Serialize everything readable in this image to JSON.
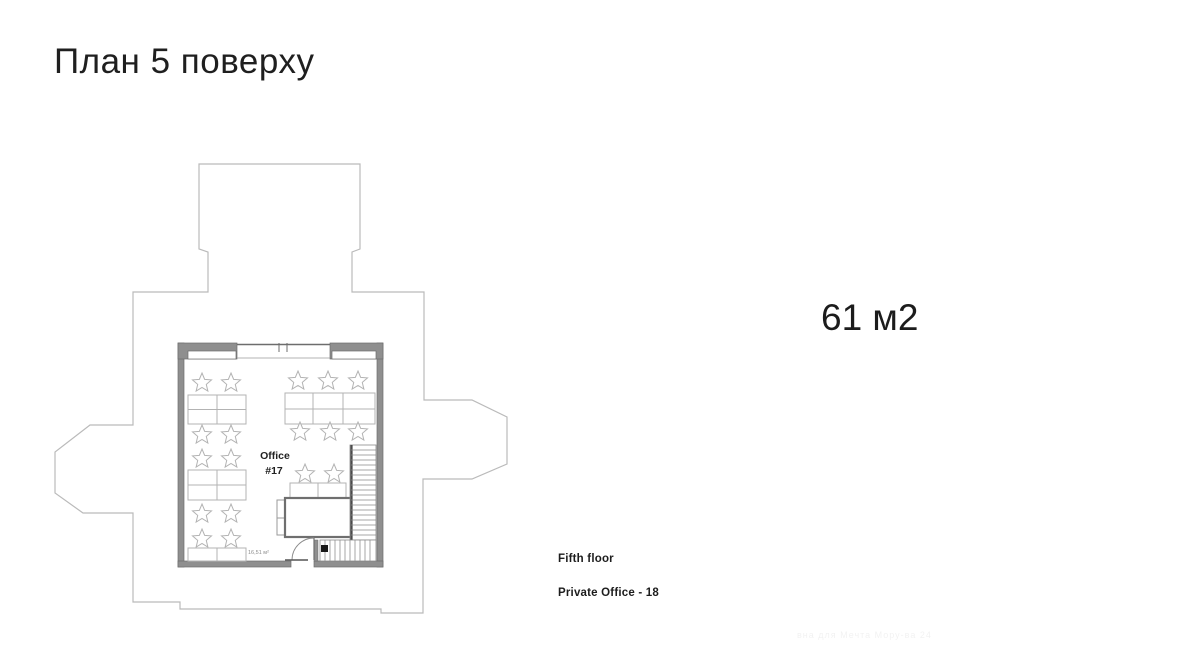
{
  "page": {
    "title": "План 5 поверху"
  },
  "area_summary": {
    "value": "61 м2"
  },
  "plan": {
    "office_label": {
      "line1": "Office",
      "line2": "#17"
    },
    "area_note": "16,51 м²"
  },
  "captions": {
    "floor": "Fifth floor",
    "listing": "Private Office - 18"
  },
  "watermark": {
    "text": "вна для Мечта Мору-ва 24"
  },
  "colors": {
    "building_outline": "#bababa",
    "wall_fill": "#8f8f8f",
    "wall_edge": "#6d6d6d",
    "furniture_stroke": "#b3b3b3",
    "stairs_stroke": "#8a8a8a",
    "table_stroke": "#6f6f6f",
    "text_dark": "#1c1c1c"
  }
}
